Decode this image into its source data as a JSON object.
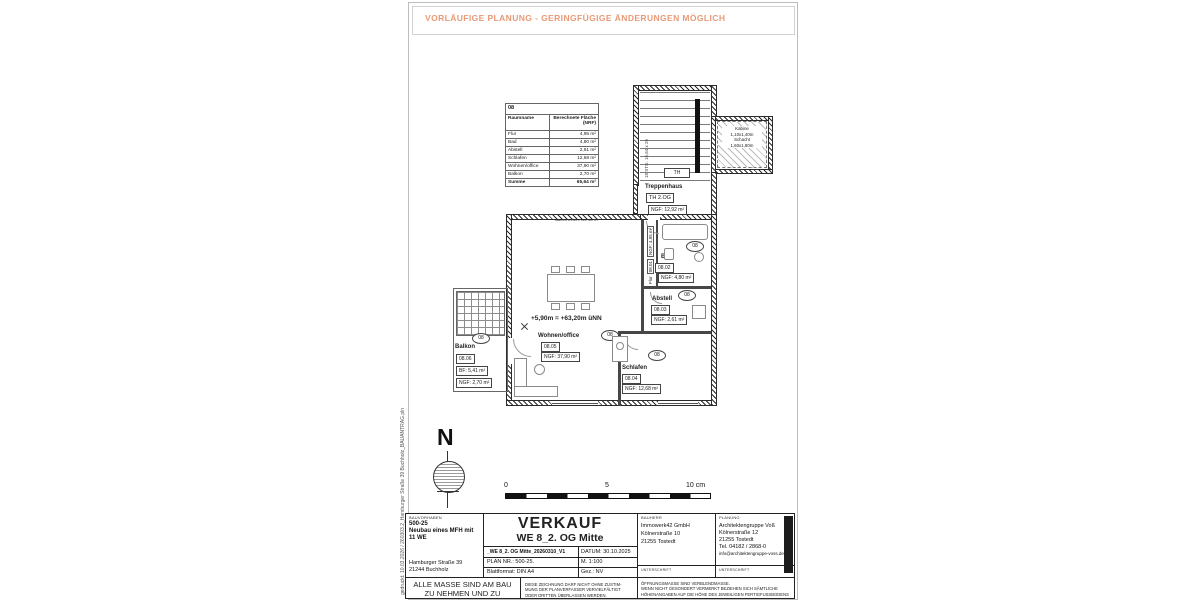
{
  "notice": "VORLÄUFIGE PLANUNG - GERINGFÜGIGE ÄNDERUNGEN MÖGLICH",
  "side_note": "gedruckt: 10.03.2026 / 260303.2_Hamburger Straße 39 Buchholz_BAUANTRAG.pln",
  "colors": {
    "accent_orange": "#e89a76",
    "line": "#222222"
  },
  "room_table": {
    "unit_no": "08",
    "header_room": "Raumname",
    "header_area": "Berechnete Fläche (NRF)",
    "rows": [
      {
        "name": "Flur",
        "area": "4,95 m²"
      },
      {
        "name": "Bad",
        "area": "4,80 m²"
      },
      {
        "name": "Abstell",
        "area": "2,61 m²"
      },
      {
        "name": "Schlafen",
        "area": "12,68 m²"
      },
      {
        "name": "Wohnen/office",
        "area": "37,90 m²"
      },
      {
        "name": "Balkon",
        "area": "2,70 m²"
      }
    ],
    "sum_label": "Summe",
    "sum_value": "65,64 m²",
    "footnote": "davon innen: ca. 63 m²"
  },
  "plan": {
    "badge": "08",
    "level_mark": "+5,90m = +63,20m üNN",
    "stair_note": "18 STG. 16,64 x 26",
    "th_small": "TH",
    "elevator": {
      "l1": "Kabine",
      "l2": "1,10x1,40m",
      "l3": "Schacht",
      "l4": "1,60x1,80m"
    },
    "treppenhaus": {
      "name": "Treppenhaus",
      "id": "TH 2.OG",
      "area": "NGF: 12,92 m²"
    },
    "flur": {
      "name": "Flur",
      "id": "08.01",
      "area": "NGF: 4,95 m²"
    },
    "bad": {
      "name": "Bad",
      "id": "08.02",
      "area": "NGF: 4,80 m²"
    },
    "abstell": {
      "name": "Abstell",
      "id": "08.03",
      "area": "NGF: 2,61 m²"
    },
    "schlafen": {
      "name": "Schlafen",
      "id": "08.04",
      "area": "NGF: 12,68 m²"
    },
    "wohnen": {
      "name": "Wohnen/office",
      "id": "08.05",
      "area": "NGF: 37,90 m²"
    },
    "balkon": {
      "name": "Balkon",
      "id": "08.06",
      "bf": "BF: 5,41 m²",
      "area": "NGF: 2,70 m²"
    }
  },
  "north_label": "N",
  "scale": {
    "t0": "0",
    "t5": "5",
    "t10": "10 cm"
  },
  "title_block": {
    "bauvorhaben_label": "BAUVORHABEN",
    "project_no": "500-25",
    "project_name": "Neubau eines MFH mit 11 WE",
    "address1": "Hamburger Straße 39",
    "address2": "21244 Buchholz",
    "title_big": "VERKAUF",
    "title_sub": "WE 8_2. OG Mitte",
    "file_name": "_WE 8_2. OG Mitte_20260310_V1",
    "datum": "DATUM: 30.10.2025",
    "plan_nr": "PLAN NR.: 500-25.",
    "scale_label": "M. 1:100",
    "format": "Blattformat: DIN A4",
    "gez": "Gez.: NV",
    "bauherr_label": "BAUHERR",
    "bauherr1": "Immowerk42  GmbH",
    "bauherr2": "Kölnerstraße 10",
    "bauherr3": "21255 Tostedt",
    "planung_label": "PLANUNG",
    "planung1": "Architektengruppe Voß",
    "planung2": "Kölnerstraße 12",
    "planung3": "21255 Tostedt",
    "planung4": "Tel. 04182 / 2868-0",
    "planung5": "info@architektengruppe-voss.de",
    "unterschrift": "UNTERSCHRIFT",
    "masse1": "ALLE MASSE SIND AM  BAU",
    "masse2": "ZU NEHMEN UND ZU PRÜFEN!",
    "copy1": "DIESE ZEICHNUNG DARF NICHT OHNE ZUSTIM-",
    "copy2": "MUNG  DER  PLANVERFASSER  VERVIELFÄLTIGT",
    "copy3": "ODER  DRITTEN  ÜBERLASSEN  WERDEN.",
    "open1": "ÖFFNUNGSMASSE SIND VERBLENDMASSE.",
    "open2": "WENN NICHT GESONDERT VERMERKT BEZIEHEN SICH SÄMTLICHE",
    "open3": "HÖHENANGABEN AUF DIE HÖHE DES JEWEILIGEN FERTIGFUSSBODENS"
  }
}
